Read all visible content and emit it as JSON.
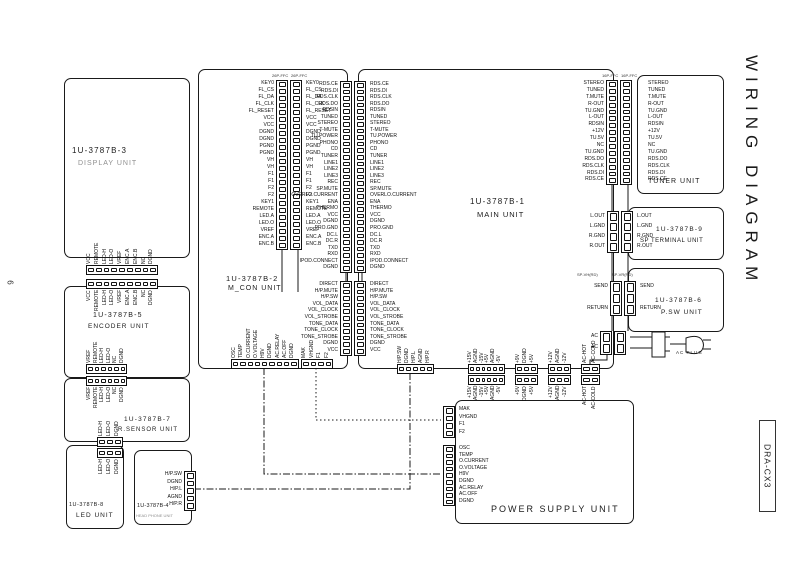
{
  "page": {
    "title": "WIRING DIAGRAM",
    "model": "DRA-CX3",
    "page_number": "6"
  },
  "colors": {
    "ink": "#1a1a1a",
    "muted": "#8f8f8f"
  },
  "units": {
    "display": {
      "id": "1U-3787B-3",
      "name": "DISPLAY UNIT"
    },
    "mcon": {
      "id": "1U-3787B-2",
      "name": "M_CON UNIT"
    },
    "main": {
      "id": "1U-3787B-1",
      "name": "MAIN UNIT"
    },
    "tuner": {
      "name": "TUNER UNIT"
    },
    "sp_terminal": {
      "id": "1U-3787B-9",
      "name": "SP TERMINAL UNIT"
    },
    "psw": {
      "id": "1U-3787B-6",
      "name": "P.SW UNIT"
    },
    "power_supply": {
      "name": "POWER SUPPLY UNIT"
    },
    "encoder": {
      "id": "1U-3787B-5",
      "name": "ENCODER UNIT"
    },
    "rsensor": {
      "id": "1U-3787B-7",
      "name": "R.SENSOR UNIT"
    },
    "led": {
      "id": "1U-3787B-8",
      "name": "LED UNIT"
    },
    "headphone": {
      "id": "1U-3787B-4",
      "name": "HEAD PHONE UNIT"
    },
    "ac_plug": {
      "name": "AC PLUG"
    }
  },
  "connectors": {
    "display_mcon": {
      "header": "26P-FFC",
      "pins": [
        "KEY0",
        "FL_CS",
        "FL_DA",
        "FL_CLK",
        "FL_RESET",
        "VCC",
        "VCC",
        "DGND",
        "DGND",
        "PGND",
        "PGND",
        "VH",
        "VH",
        "F1",
        "F1",
        "F2",
        "F2",
        "KEY1",
        "REMOTE",
        "LED.A",
        "LED.O",
        "VREF",
        "ENC.A",
        "ENC.B"
      ]
    },
    "mcon_main_a": {
      "pins": [
        "RDS.CE",
        "RDS.DI",
        "RDS.CLK",
        "RDS.DO",
        "RDSIN",
        "TUNED",
        "STEREO",
        "T-MUTE",
        "TU.POWER",
        "PHONO",
        "CD",
        "TUNER",
        "LINE1",
        "LINE2",
        "LINE3",
        "REC",
        "SP.MUTE",
        "OVERLO.CURRENT",
        "ENA",
        "THERMO",
        "VCC",
        "DGND",
        "PRO.GND",
        "DC.L",
        "DC.R",
        "TXD",
        "RXD",
        "IPOD.CONNECT",
        "DGND"
      ]
    },
    "mcon_main_b": {
      "pins": [
        "DIRECT",
        "H/P.MUTE",
        "H/P.SW",
        "VOL_DATA",
        "VOL_CLOCK",
        "VOL_STROBE",
        "TONE_DATA",
        "TONE_CLOCK",
        "TONE_STROBE",
        "DGND",
        "VCC"
      ]
    },
    "main_tuner": {
      "header": "16P-FFC",
      "pins": [
        "STEREO",
        "TUNED",
        "T.MUTE",
        "R-OUT",
        "TU.GND",
        "L-OUT",
        "RDSIN",
        "+12V",
        "TU.5V",
        "NC",
        "TU.GND",
        "RDS.DO",
        "RDS.CLK",
        "RDS.DI",
        "RDS.CE"
      ]
    },
    "sp_terminal": {
      "pins": [
        "L.OUT",
        "L.GND",
        "R.GND",
        "R.OUT"
      ]
    },
    "psw": {
      "header_left": "SP-VH(RD)",
      "header_right": "SP-VR(RD)",
      "pins": [
        "SEND",
        "",
        "RETURN"
      ]
    },
    "ac_input": {
      "pins": [
        "AC",
        "AC"
      ]
    },
    "display_encoder": {
      "pins": [
        "VCC",
        "REMOTE",
        "LED-H",
        "LED-O",
        "VREF",
        "ENC.A",
        "ENC.B",
        "NC",
        "DGND"
      ]
    },
    "encoder_rsensor": {
      "pins": [
        "VREF",
        "REMOTE",
        "LED-H",
        "LED-O",
        "NC",
        "DGND"
      ]
    },
    "rsensor_led": {
      "pins": [
        "LED-H",
        "LED-O",
        "DGND"
      ]
    },
    "headphone": {
      "pins": [
        "H/P.SW",
        "DGND",
        "H/P.L",
        "AGND",
        "H/P.R"
      ]
    },
    "mcon_ps_control": {
      "pins": [
        "OSC",
        "TEMP",
        "O.CURRENT",
        "O.VOLTAGE",
        "H9V",
        "DGND",
        "AC.RELAY",
        "AC.OFF",
        "DGND"
      ]
    },
    "mcon_ps_filament": {
      "pins": [
        "MAK",
        "VHGND",
        "F1",
        "F2"
      ]
    },
    "main_ps_a": {
      "pins": [
        "+15V",
        "AGND",
        "-15V",
        "+5V",
        "AGND",
        "-5V"
      ]
    },
    "main_ps_b": {
      "pins": [
        "+9V",
        "DGND",
        "+5V"
      ]
    },
    "main_ps_c": {
      "pins": [
        "+12V",
        "AGND",
        "-12V"
      ]
    },
    "main_ps_ac": {
      "pins": [
        "AC-HOT",
        "AC-COLD"
      ]
    }
  }
}
